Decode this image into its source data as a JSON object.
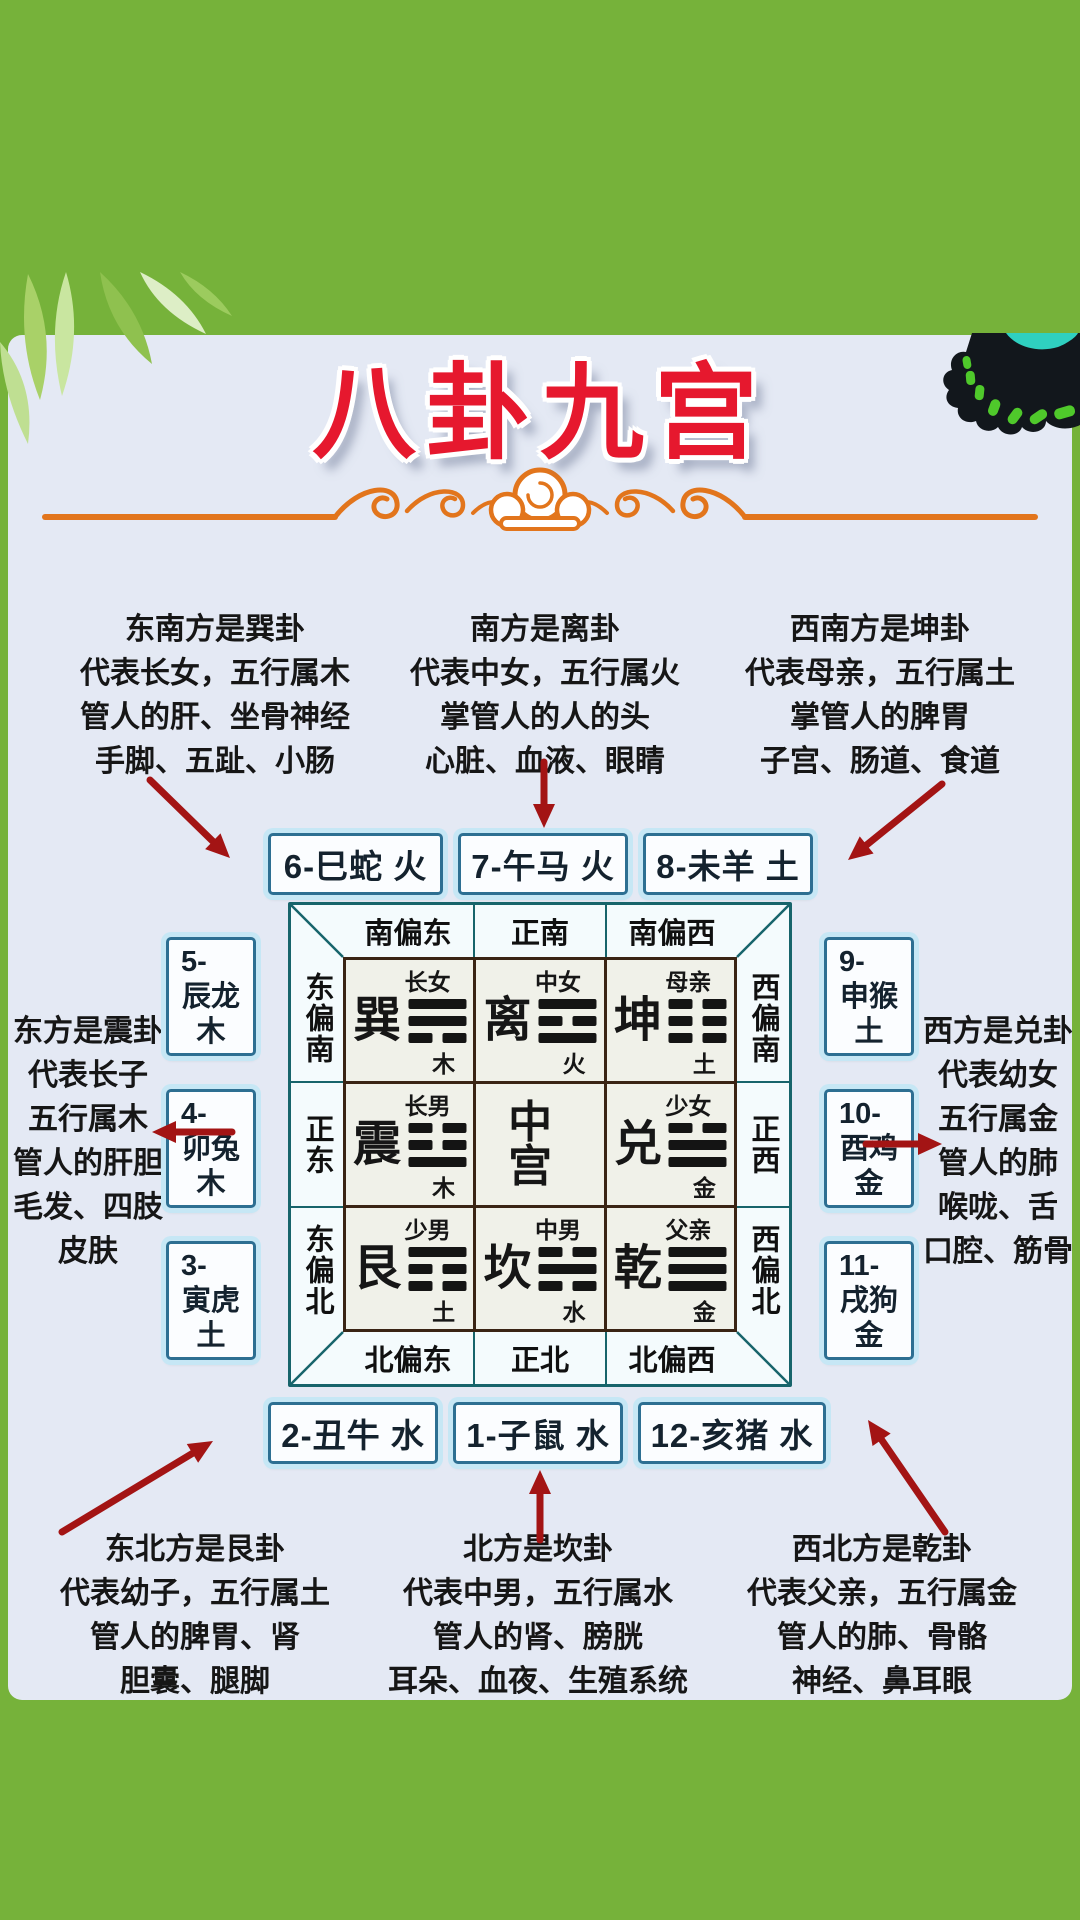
{
  "title": "八卦九宫",
  "info_blocks": {
    "southeast": [
      "东南方是巽卦",
      "代表长女，五行属木",
      "管人的肝、坐骨神经",
      "手脚、五趾、小肠"
    ],
    "south": [
      "南方是离卦",
      "代表中女，五行属火",
      "掌管人的人的头",
      "心脏、血液、眼睛"
    ],
    "southwest": [
      "西南方是坤卦",
      "代表母亲，五行属土",
      "掌管人的脾胃",
      "子宫、肠道、食道"
    ],
    "east": [
      "东方是震卦",
      "代表长子",
      "五行属木",
      "管人的肝胆",
      "毛发、四肢",
      "皮肤"
    ],
    "west": [
      "西方是兑卦",
      "代表幼女",
      "五行属金",
      "管人的肺",
      "喉咙、舌",
      "口腔、筋骨"
    ],
    "northeast": [
      "东北方是艮卦",
      "代表幼子，五行属土",
      "管人的脾胃、肾",
      "胆囊、腿脚"
    ],
    "north": [
      "北方是坎卦",
      "代表中男，五行属水",
      "管人的肾、膀胱",
      "耳朵、血夜、生殖系统"
    ],
    "northwest": [
      "西北方是乾卦",
      "代表父亲，五行属金",
      "管人的肺、骨骼",
      "神经、鼻耳眼"
    ]
  },
  "zodiac_boxes": {
    "top": [
      "6-巳蛇 火",
      "7-午马 火",
      "8-未羊 土"
    ],
    "bottom": [
      "2-丑牛 水",
      "1-子鼠 水",
      "12-亥猪 水"
    ],
    "left": [
      [
        "5-",
        "辰龙",
        "木"
      ],
      [
        "4-",
        "卯兔",
        "木"
      ],
      [
        "3-",
        "寅虎",
        "土"
      ]
    ],
    "right": [
      [
        "9-",
        "申猴",
        "土"
      ],
      [
        "10-",
        "酉鸡",
        "金"
      ],
      [
        "11-",
        "戌狗",
        "金"
      ]
    ]
  },
  "grid": {
    "direction_labels": {
      "top": [
        "南偏东",
        "正南",
        "南偏西"
      ],
      "bottom": [
        "北偏东",
        "正北",
        "北偏西"
      ],
      "left": [
        "东偏南",
        "正东",
        "东偏北"
      ],
      "right": [
        "西偏南",
        "正西",
        "西偏北"
      ]
    },
    "cells": [
      {
        "name": "巽",
        "role": "长女",
        "element": "木",
        "trigram": [
          1,
          1,
          0
        ]
      },
      {
        "name": "离",
        "role": "中女",
        "element": "火",
        "trigram": [
          1,
          0,
          1
        ]
      },
      {
        "name": "坤",
        "role": "母亲",
        "element": "土",
        "trigram": [
          0,
          0,
          0
        ]
      },
      {
        "name": "震",
        "role": "长男",
        "element": "木",
        "trigram": [
          0,
          0,
          1
        ]
      },
      {
        "name": "中宫",
        "role": "",
        "element": "",
        "trigram": []
      },
      {
        "name": "兑",
        "role": "少女",
        "element": "金",
        "trigram": [
          0,
          1,
          1
        ]
      },
      {
        "name": "艮",
        "role": "少男",
        "element": "土",
        "trigram": [
          1,
          0,
          0
        ]
      },
      {
        "name": "坎",
        "role": "中男",
        "element": "水",
        "trigram": [
          0,
          1,
          0
        ]
      },
      {
        "name": "乾",
        "role": "父亲",
        "element": "金",
        "trigram": [
          1,
          1,
          1
        ]
      }
    ]
  },
  "colors": {
    "green": "#76b23a",
    "card": "#e4e9f4",
    "title_red": "#e6182e",
    "divider_orange": "#e2751c",
    "box_border": "#2d6f92",
    "box_glow": "#c6e7f5",
    "frame_teal": "#17646b",
    "grid_brown": "#3a2414",
    "cell_bg": "#f0f1e9",
    "arrow_red": "#a31414",
    "text": "#161616"
  }
}
